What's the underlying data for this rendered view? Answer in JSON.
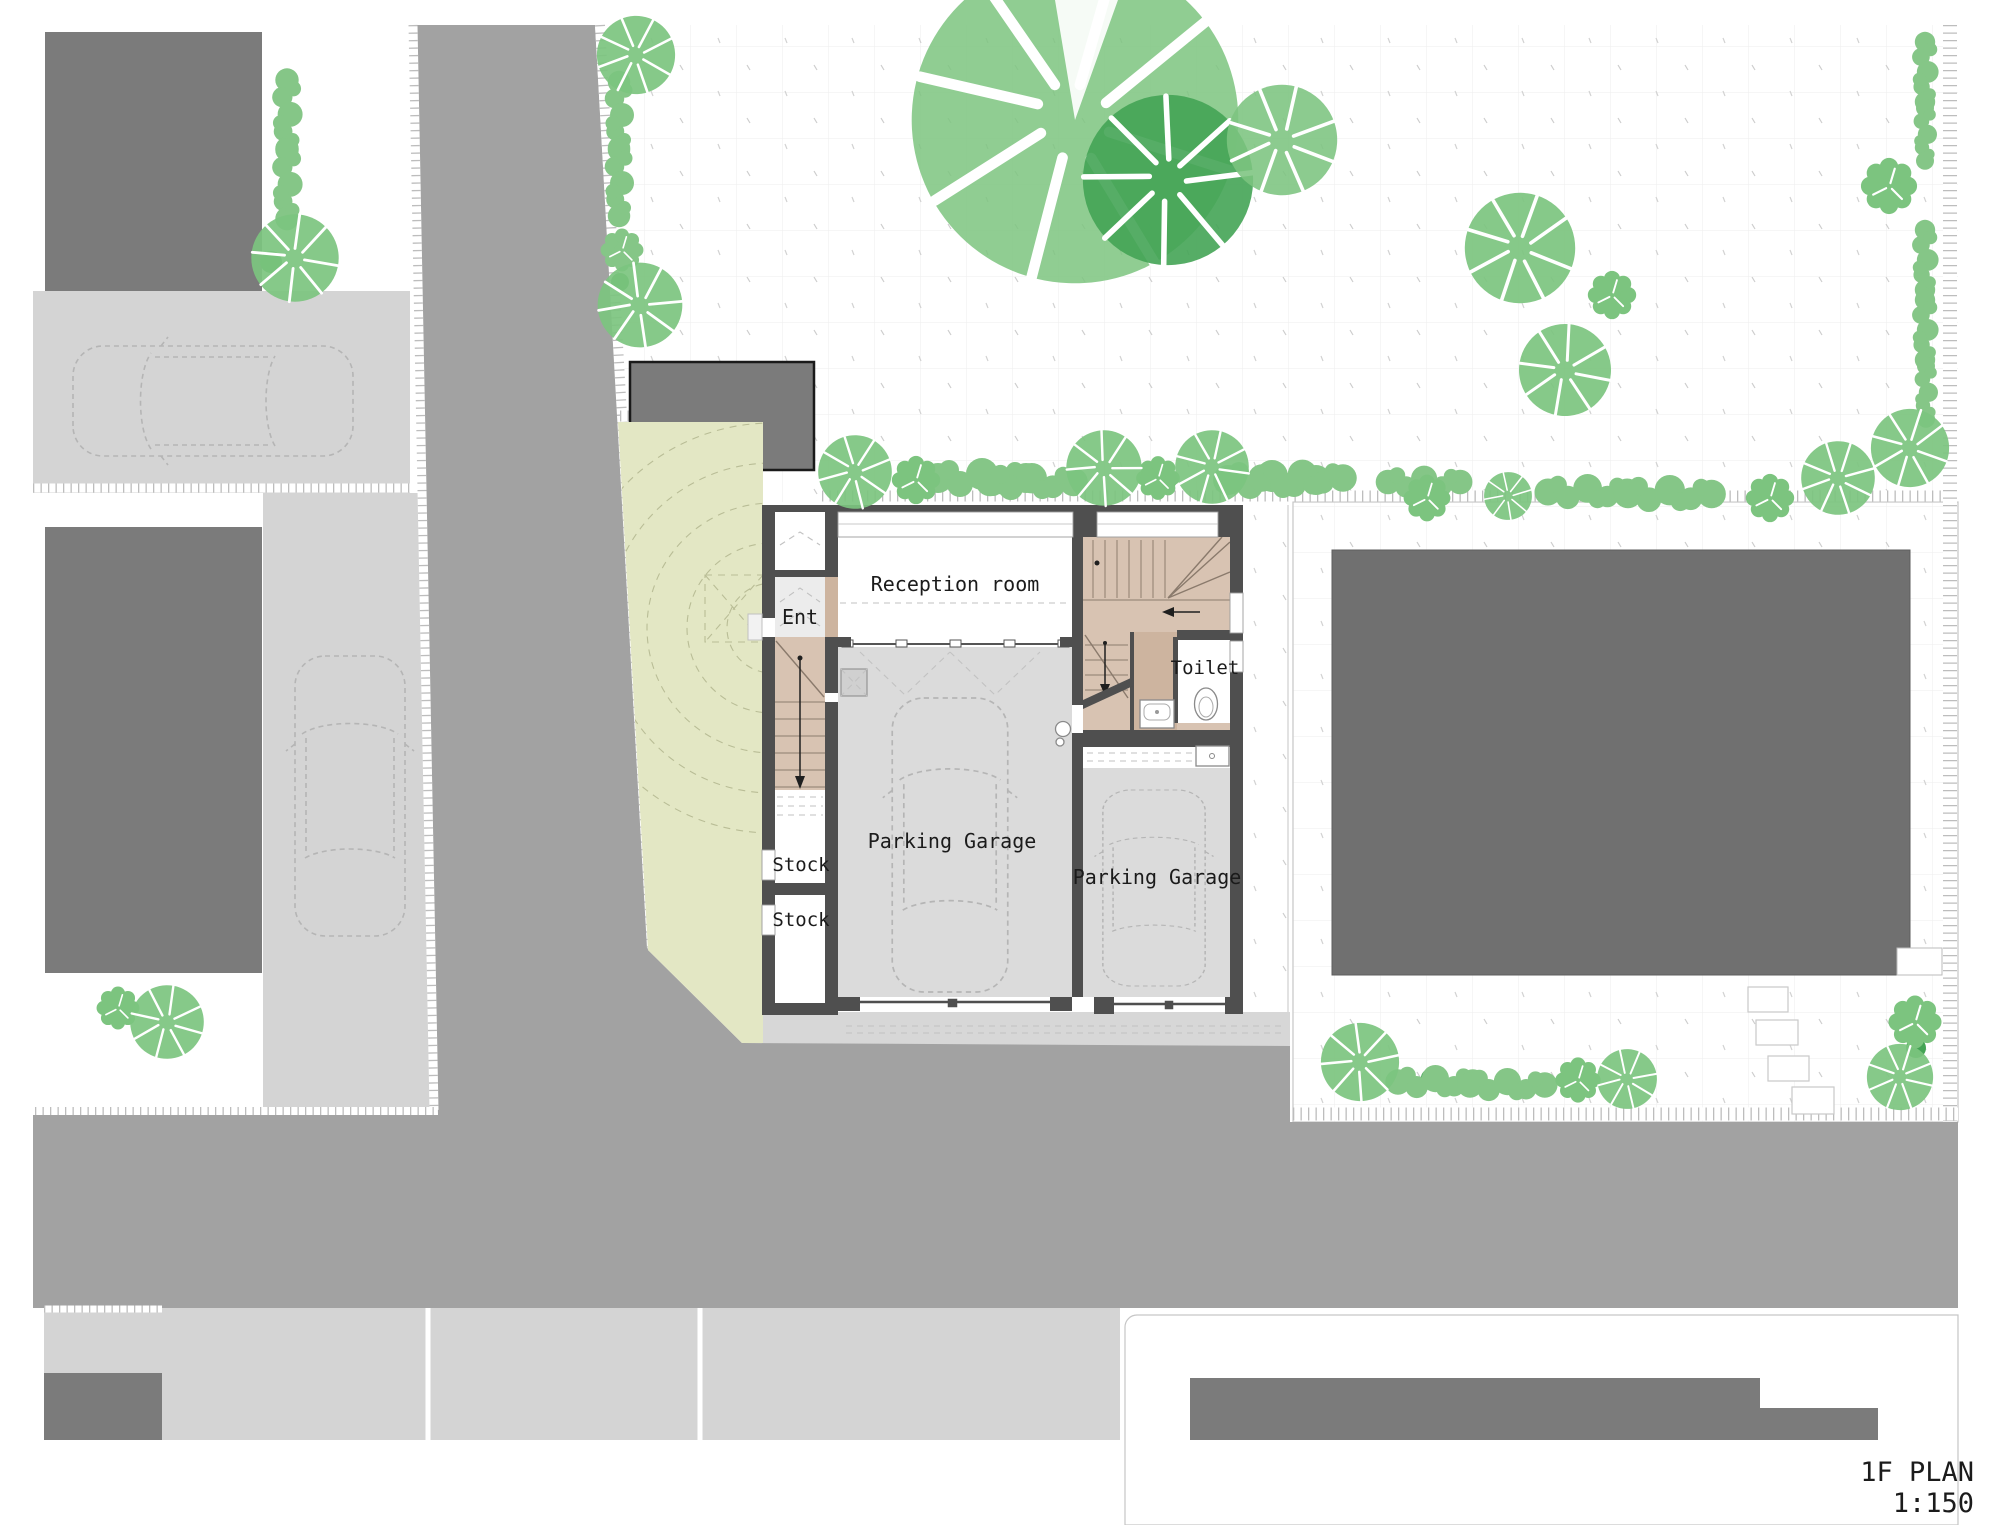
{
  "title_block": {
    "name": "1F PLAN",
    "scale": "1:150"
  },
  "rooms": {
    "reception": "Reception room",
    "entrance": "Ent",
    "toilet": "Toilet",
    "parking_garage_main": "Parking Garage",
    "parking_garage_second": "Parking Garage",
    "stock_upper": "Stock",
    "stock_lower": "Stock"
  },
  "colors": {
    "road": "#a2a2a2",
    "pavement": "#d4d4d4",
    "garage-floor": "#dbdbdb",
    "building": "#7b7b7b",
    "building-right": "#707070",
    "wall": "#4f4f4f",
    "wood": "#d8c3b2",
    "wood-dark": "#cdb49f",
    "yard": "#e3e7c4",
    "tree": "#7cc47f",
    "tree-dark": "#44a455",
    "hedge": "#85c687",
    "ent-floor": "#ececec",
    "text": "#1b1b1b"
  }
}
